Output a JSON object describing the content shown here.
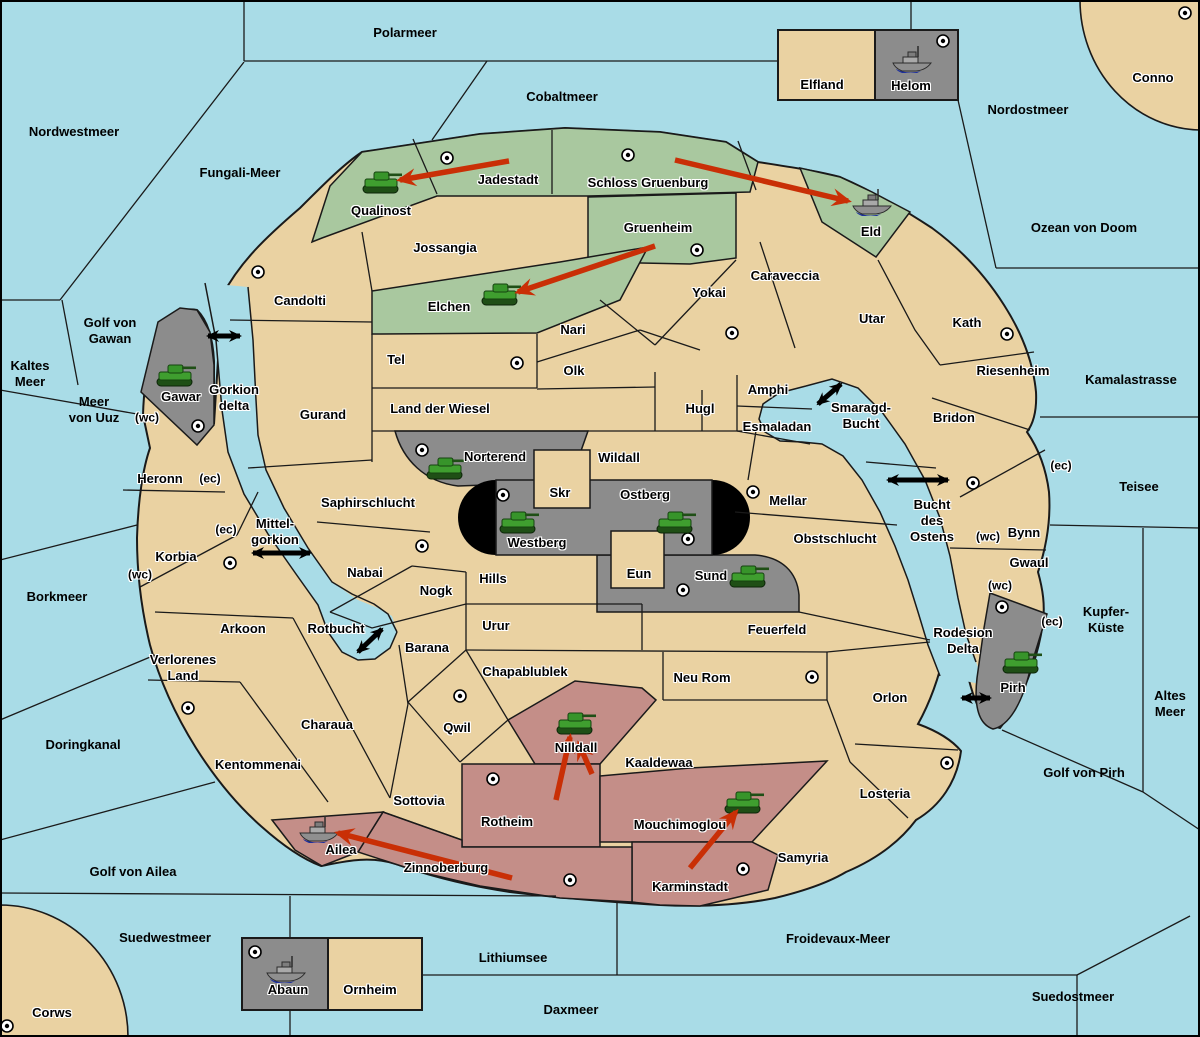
{
  "map": {
    "title": "Fantasy Diplomacy variant map",
    "colors": {
      "sea": "#A9DCE7",
      "land": "#EAD2A2",
      "green_power": "#A9C89F",
      "red_power": "#C48E88",
      "gray_power": "#8C8C8C",
      "impassable": "#000000",
      "move_arrow": "#C92F06",
      "link_arrow": "#000000",
      "border": "#1A1A1A",
      "supply_center": "#FFFFFF"
    },
    "labels": [
      {
        "t": [
          "Polarmeer"
        ],
        "x": 405,
        "y": 33,
        "k": "sea"
      },
      {
        "t": [
          "Cobaltmeer"
        ],
        "x": 562,
        "y": 97,
        "k": "sea"
      },
      {
        "t": [
          "Nordwestmeer"
        ],
        "x": 74,
        "y": 132,
        "k": "sea"
      },
      {
        "t": [
          "Fungali-Meer"
        ],
        "x": 240,
        "y": 173,
        "k": "sea"
      },
      {
        "t": [
          "Nordostmeer"
        ],
        "x": 1028,
        "y": 110,
        "k": "sea"
      },
      {
        "t": [
          "Ozean von Doom"
        ],
        "x": 1084,
        "y": 228,
        "k": "sea"
      },
      {
        "t": [
          "Kaltes",
          "Meer"
        ],
        "x": 30,
        "y": 374,
        "k": "sea"
      },
      {
        "t": [
          "Golf von",
          "Gawan"
        ],
        "x": 110,
        "y": 331,
        "k": "sea"
      },
      {
        "t": [
          "Meer",
          "von Uuz"
        ],
        "x": 94,
        "y": 410,
        "k": "sea"
      },
      {
        "t": [
          "Kamalastrasse"
        ],
        "x": 1131,
        "y": 380,
        "k": "sea"
      },
      {
        "t": [
          "Teisee"
        ],
        "x": 1139,
        "y": 487,
        "k": "sea"
      },
      {
        "t": [
          "Borkmeer"
        ],
        "x": 57,
        "y": 597,
        "k": "sea"
      },
      {
        "t": [
          "Kupfer-",
          "Küste"
        ],
        "x": 1106,
        "y": 620,
        "k": "sea"
      },
      {
        "t": [
          "Altes",
          "Meer"
        ],
        "x": 1170,
        "y": 704,
        "k": "sea"
      },
      {
        "t": [
          "Doringkanal"
        ],
        "x": 83,
        "y": 745,
        "k": "sea"
      },
      {
        "t": [
          "Golf von Pirh"
        ],
        "x": 1084,
        "y": 773,
        "k": "sea"
      },
      {
        "t": [
          "Golf von Ailea"
        ],
        "x": 133,
        "y": 872,
        "k": "sea"
      },
      {
        "t": [
          "Suedwestmeer"
        ],
        "x": 165,
        "y": 938,
        "k": "sea"
      },
      {
        "t": [
          "Froidevaux-Meer"
        ],
        "x": 838,
        "y": 939,
        "k": "sea"
      },
      {
        "t": [
          "Lithiumsee"
        ],
        "x": 513,
        "y": 958,
        "k": "sea"
      },
      {
        "t": [
          "Daxmeer"
        ],
        "x": 571,
        "y": 1010,
        "k": "sea"
      },
      {
        "t": [
          "Suedostmeer"
        ],
        "x": 1073,
        "y": 997,
        "k": "sea"
      },
      {
        "t": [
          "Gorkion",
          "delta"
        ],
        "x": 234,
        "y": 398,
        "k": "strait"
      },
      {
        "t": [
          "Mittel-",
          "gorkion"
        ],
        "x": 275,
        "y": 532,
        "k": "strait"
      },
      {
        "t": [
          "Smaragd-",
          "Bucht"
        ],
        "x": 861,
        "y": 416,
        "k": "strait"
      },
      {
        "t": [
          "Bucht",
          "des",
          "Ostens"
        ],
        "x": 932,
        "y": 521,
        "k": "strait"
      },
      {
        "t": [
          "Rotbucht"
        ],
        "x": 336,
        "y": 629,
        "k": "strait"
      },
      {
        "t": [
          "Rodesion",
          "Delta"
        ],
        "x": 963,
        "y": 641,
        "k": "strait"
      },
      {
        "t": [
          "Qualinost"
        ],
        "x": 381,
        "y": 211,
        "k": "land"
      },
      {
        "t": [
          "Jadestadt"
        ],
        "x": 508,
        "y": 180,
        "k": "land"
      },
      {
        "t": [
          "Schloss Gruenburg"
        ],
        "x": 648,
        "y": 183,
        "k": "land"
      },
      {
        "t": [
          "Gruenheim"
        ],
        "x": 658,
        "y": 228,
        "k": "land"
      },
      {
        "t": [
          "Eld"
        ],
        "x": 871,
        "y": 232,
        "k": "land"
      },
      {
        "t": [
          "Jossangia"
        ],
        "x": 445,
        "y": 248,
        "k": "land"
      },
      {
        "t": [
          "Elchen"
        ],
        "x": 449,
        "y": 307,
        "k": "land"
      },
      {
        "t": [
          "Candolti"
        ],
        "x": 300,
        "y": 301,
        "k": "land"
      },
      {
        "t": [
          "Caraveccia"
        ],
        "x": 785,
        "y": 276,
        "k": "land"
      },
      {
        "t": [
          "Yokai"
        ],
        "x": 709,
        "y": 293,
        "k": "land"
      },
      {
        "t": [
          "Utar"
        ],
        "x": 872,
        "y": 319,
        "k": "land"
      },
      {
        "t": [
          "Kath"
        ],
        "x": 967,
        "y": 323,
        "k": "land"
      },
      {
        "t": [
          "Nari"
        ],
        "x": 573,
        "y": 330,
        "k": "land"
      },
      {
        "t": [
          "Tel"
        ],
        "x": 396,
        "y": 360,
        "k": "land"
      },
      {
        "t": [
          "Olk"
        ],
        "x": 574,
        "y": 371,
        "k": "land"
      },
      {
        "t": [
          "Riesenheim"
        ],
        "x": 1013,
        "y": 371,
        "k": "land"
      },
      {
        "t": [
          "Gurand"
        ],
        "x": 323,
        "y": 415,
        "k": "land"
      },
      {
        "t": [
          "Land der Wiesel"
        ],
        "x": 440,
        "y": 409,
        "k": "land"
      },
      {
        "t": [
          "Hugl"
        ],
        "x": 700,
        "y": 409,
        "k": "land"
      },
      {
        "t": [
          "Amphi"
        ],
        "x": 768,
        "y": 390,
        "k": "land"
      },
      {
        "t": [
          "Esmaladan"
        ],
        "x": 777,
        "y": 427,
        "k": "land"
      },
      {
        "t": [
          "Bridon"
        ],
        "x": 954,
        "y": 418,
        "k": "land"
      },
      {
        "t": [
          "Norterend"
        ],
        "x": 495,
        "y": 457,
        "k": "land"
      },
      {
        "t": [
          "Wildall"
        ],
        "x": 619,
        "y": 458,
        "k": "land"
      },
      {
        "t": [
          "Skr"
        ],
        "x": 560,
        "y": 493,
        "k": "land"
      },
      {
        "t": [
          "Ostberg"
        ],
        "x": 645,
        "y": 495,
        "k": "land"
      },
      {
        "t": [
          "Mellar"
        ],
        "x": 788,
        "y": 501,
        "k": "land"
      },
      {
        "t": [
          "Heronn"
        ],
        "x": 160,
        "y": 479,
        "k": "land"
      },
      {
        "t": [
          "Saphirschlucht"
        ],
        "x": 368,
        "y": 503,
        "k": "land"
      },
      {
        "t": [
          "Westberg"
        ],
        "x": 537,
        "y": 543,
        "k": "land"
      },
      {
        "t": [
          "Bynn"
        ],
        "x": 1024,
        "y": 533,
        "k": "land"
      },
      {
        "t": [
          "Korbia"
        ],
        "x": 176,
        "y": 557,
        "k": "land"
      },
      {
        "t": [
          "Obstschlucht"
        ],
        "x": 835,
        "y": 539,
        "k": "land"
      },
      {
        "t": [
          "Gwaul"
        ],
        "x": 1029,
        "y": 563,
        "k": "land"
      },
      {
        "t": [
          "Eun"
        ],
        "x": 639,
        "y": 574,
        "k": "land"
      },
      {
        "t": [
          "Sund"
        ],
        "x": 711,
        "y": 576,
        "k": "land"
      },
      {
        "t": [
          "Nabai"
        ],
        "x": 365,
        "y": 573,
        "k": "land"
      },
      {
        "t": [
          "Hills"
        ],
        "x": 493,
        "y": 579,
        "k": "land"
      },
      {
        "t": [
          "Nogk"
        ],
        "x": 436,
        "y": 591,
        "k": "land"
      },
      {
        "t": [
          "Arkoon"
        ],
        "x": 243,
        "y": 629,
        "k": "land"
      },
      {
        "t": [
          "Urur"
        ],
        "x": 496,
        "y": 626,
        "k": "land"
      },
      {
        "t": [
          "Feuerfeld"
        ],
        "x": 777,
        "y": 630,
        "k": "land"
      },
      {
        "t": [
          "Barana"
        ],
        "x": 427,
        "y": 648,
        "k": "land"
      },
      {
        "t": [
          "Verlorenes",
          "Land"
        ],
        "x": 183,
        "y": 668,
        "k": "land"
      },
      {
        "t": [
          "Chapablublek"
        ],
        "x": 525,
        "y": 672,
        "k": "land"
      },
      {
        "t": [
          "Neu Rom"
        ],
        "x": 702,
        "y": 678,
        "k": "land"
      },
      {
        "t": [
          "Orlon"
        ],
        "x": 890,
        "y": 698,
        "k": "land"
      },
      {
        "t": [
          "Pirh"
        ],
        "x": 1013,
        "y": 688,
        "k": "land"
      },
      {
        "t": [
          "Charaua"
        ],
        "x": 327,
        "y": 725,
        "k": "land"
      },
      {
        "t": [
          "Qwil"
        ],
        "x": 457,
        "y": 728,
        "k": "land"
      },
      {
        "t": [
          "Nilldall"
        ],
        "x": 576,
        "y": 748,
        "k": "land"
      },
      {
        "t": [
          "Kaaldewaa"
        ],
        "x": 659,
        "y": 763,
        "k": "land"
      },
      {
        "t": [
          "Kentommenai"
        ],
        "x": 258,
        "y": 765,
        "k": "land"
      },
      {
        "t": [
          "Losteria"
        ],
        "x": 885,
        "y": 794,
        "k": "land"
      },
      {
        "t": [
          "Sottovia"
        ],
        "x": 419,
        "y": 801,
        "k": "land"
      },
      {
        "t": [
          "Samyria"
        ],
        "x": 803,
        "y": 858,
        "k": "land"
      },
      {
        "t": [
          "Rotheim"
        ],
        "x": 507,
        "y": 822,
        "k": "land"
      },
      {
        "t": [
          "Mouchimoglou"
        ],
        "x": 680,
        "y": 825,
        "k": "land"
      },
      {
        "t": [
          "Ailea"
        ],
        "x": 341,
        "y": 850,
        "k": "land"
      },
      {
        "t": [
          "Zinnoberburg"
        ],
        "x": 446,
        "y": 868,
        "k": "land"
      },
      {
        "t": [
          "Karminstadt"
        ],
        "x": 690,
        "y": 887,
        "k": "land"
      },
      {
        "t": [
          "Gawar"
        ],
        "x": 181,
        "y": 397,
        "k": "land"
      },
      {
        "t": [
          "Elfland"
        ],
        "x": 822,
        "y": 85,
        "k": "land"
      },
      {
        "t": [
          "Helom"
        ],
        "x": 911,
        "y": 86,
        "k": "land"
      },
      {
        "t": [
          "Abaun"
        ],
        "x": 288,
        "y": 990,
        "k": "land"
      },
      {
        "t": [
          "Ornheim"
        ],
        "x": 370,
        "y": 990,
        "k": "land"
      },
      {
        "t": [
          "Conno"
        ],
        "x": 1153,
        "y": 78,
        "k": "land"
      },
      {
        "t": [
          "Corws"
        ],
        "x": 52,
        "y": 1013,
        "k": "land"
      },
      {
        "t": [
          "(wc)"
        ],
        "x": 147,
        "y": 418,
        "k": "coast"
      },
      {
        "t": [
          "(ec)"
        ],
        "x": 210,
        "y": 479,
        "k": "coast"
      },
      {
        "t": [
          "(ec)"
        ],
        "x": 226,
        "y": 530,
        "k": "coast"
      },
      {
        "t": [
          "(wc)"
        ],
        "x": 140,
        "y": 575,
        "k": "coast"
      },
      {
        "t": [
          "(ec)"
        ],
        "x": 1061,
        "y": 466,
        "k": "coast"
      },
      {
        "t": [
          "(wc)"
        ],
        "x": 988,
        "y": 537,
        "k": "coast"
      },
      {
        "t": [
          "(wc)"
        ],
        "x": 1000,
        "y": 586,
        "k": "coast"
      },
      {
        "t": [
          "(ec)"
        ],
        "x": 1052,
        "y": 622,
        "k": "coast"
      }
    ],
    "supply_centers": [
      {
        "at": "Helom",
        "x": 943,
        "y": 41
      },
      {
        "at": "Conno",
        "x": 1185,
        "y": 13
      },
      {
        "at": "Jadestadt",
        "x": 447,
        "y": 158
      },
      {
        "at": "Schloss Gruenburg",
        "x": 628,
        "y": 155
      },
      {
        "at": "Gruenheim",
        "x": 697,
        "y": 250
      },
      {
        "at": "Candolti",
        "x": 258,
        "y": 272
      },
      {
        "at": "Yokai",
        "x": 732,
        "y": 333
      },
      {
        "at": "Kath",
        "x": 1007,
        "y": 334
      },
      {
        "at": "Tel",
        "x": 517,
        "y": 363
      },
      {
        "at": "Gawar",
        "x": 198,
        "y": 426
      },
      {
        "at": "Norterend",
        "x": 422,
        "y": 450
      },
      {
        "at": "Bridon",
        "x": 973,
        "y": 483
      },
      {
        "at": "Mellar",
        "x": 753,
        "y": 492
      },
      {
        "at": "Westberg",
        "x": 503,
        "y": 495
      },
      {
        "at": "Ostberg",
        "x": 688,
        "y": 539
      },
      {
        "at": "Nabai",
        "x": 422,
        "y": 546
      },
      {
        "at": "Korbia",
        "x": 230,
        "y": 563
      },
      {
        "at": "Sund",
        "x": 683,
        "y": 590
      },
      {
        "at": "Pirh",
        "x": 1002,
        "y": 607
      },
      {
        "at": "Qwil",
        "x": 460,
        "y": 696
      },
      {
        "at": "Neu Rom",
        "x": 812,
        "y": 677
      },
      {
        "at": "Verlorenes Land",
        "x": 188,
        "y": 708
      },
      {
        "at": "Losteria",
        "x": 947,
        "y": 763
      },
      {
        "at": "Rotheim",
        "x": 493,
        "y": 779
      },
      {
        "at": "Karminstadt",
        "x": 743,
        "y": 869
      },
      {
        "at": "Zinnoberburg",
        "x": 570,
        "y": 880
      },
      {
        "at": "Abaun",
        "x": 255,
        "y": 952
      },
      {
        "at": "Corws",
        "x": 7,
        "y": 1026
      }
    ],
    "units": [
      {
        "type": "tank",
        "at": "Qualinost",
        "x": 381,
        "y": 184
      },
      {
        "type": "tank",
        "at": "Elchen",
        "x": 500,
        "y": 296
      },
      {
        "type": "tank",
        "at": "Gawar",
        "x": 175,
        "y": 377
      },
      {
        "type": "tank",
        "at": "Norterend",
        "x": 445,
        "y": 470
      },
      {
        "type": "tank",
        "at": "Westberg",
        "x": 518,
        "y": 524
      },
      {
        "type": "tank",
        "at": "Ostberg",
        "x": 675,
        "y": 524
      },
      {
        "type": "tank",
        "at": "Sund",
        "x": 748,
        "y": 578
      },
      {
        "type": "tank",
        "at": "Pirh",
        "x": 1021,
        "y": 664
      },
      {
        "type": "tank",
        "at": "Nilldall",
        "x": 575,
        "y": 725
      },
      {
        "type": "tank",
        "at": "Mouchimoglou",
        "x": 743,
        "y": 804
      },
      {
        "type": "fleet",
        "at": "Helom",
        "x": 912,
        "y": 60
      },
      {
        "type": "fleet",
        "at": "Eld",
        "x": 872,
        "y": 203
      },
      {
        "type": "fleet",
        "at": "Ailea",
        "x": 319,
        "y": 830
      },
      {
        "type": "fleet",
        "at": "Abaun",
        "x": 286,
        "y": 970
      }
    ],
    "move_arrows": [
      {
        "from": "Jadestadt",
        "to": "Qualinost",
        "x1": 509,
        "y1": 161,
        "x2": 400,
        "y2": 180
      },
      {
        "from": "Schloss Gruenburg",
        "to": "Eld",
        "x1": 675,
        "y1": 160,
        "x2": 848,
        "y2": 201
      },
      {
        "from": "Gruenheim",
        "to": "Elchen",
        "x1": 655,
        "y1": 246,
        "x2": 518,
        "y2": 292
      },
      {
        "from": "Rotheim",
        "to": "Nilldall",
        "x1": 556,
        "y1": 800,
        "x2": 570,
        "y2": 737
      },
      {
        "from": "Kaaldewaa",
        "to": "Nilldall",
        "x1": 592,
        "y1": 774,
        "x2": 579,
        "y2": 744
      },
      {
        "from": "Karminstadt",
        "to": "Mouchimoglou",
        "x1": 690,
        "y1": 868,
        "x2": 736,
        "y2": 812
      },
      {
        "from": "Zinnoberburg",
        "to": "Ailea",
        "x1": 512,
        "y1": 878,
        "x2": 338,
        "y2": 833
      }
    ],
    "link_arrows": [
      {
        "at": "Gorkion delta",
        "x1": 208,
        "y1": 336,
        "x2": 240,
        "y2": 336
      },
      {
        "at": "Mittel-gorkion",
        "x1": 253,
        "y1": 553,
        "x2": 310,
        "y2": 553
      },
      {
        "at": "Smaragd-Bucht",
        "x1": 818,
        "y1": 404,
        "x2": 841,
        "y2": 384
      },
      {
        "at": "Bucht des Ostens",
        "x1": 888,
        "y1": 480,
        "x2": 948,
        "y2": 480
      },
      {
        "at": "Rotbucht",
        "x1": 358,
        "y1": 652,
        "x2": 382,
        "y2": 629
      },
      {
        "at": "Rodesion Delta",
        "x1": 962,
        "y1": 698,
        "x2": 990,
        "y2": 698
      }
    ]
  }
}
